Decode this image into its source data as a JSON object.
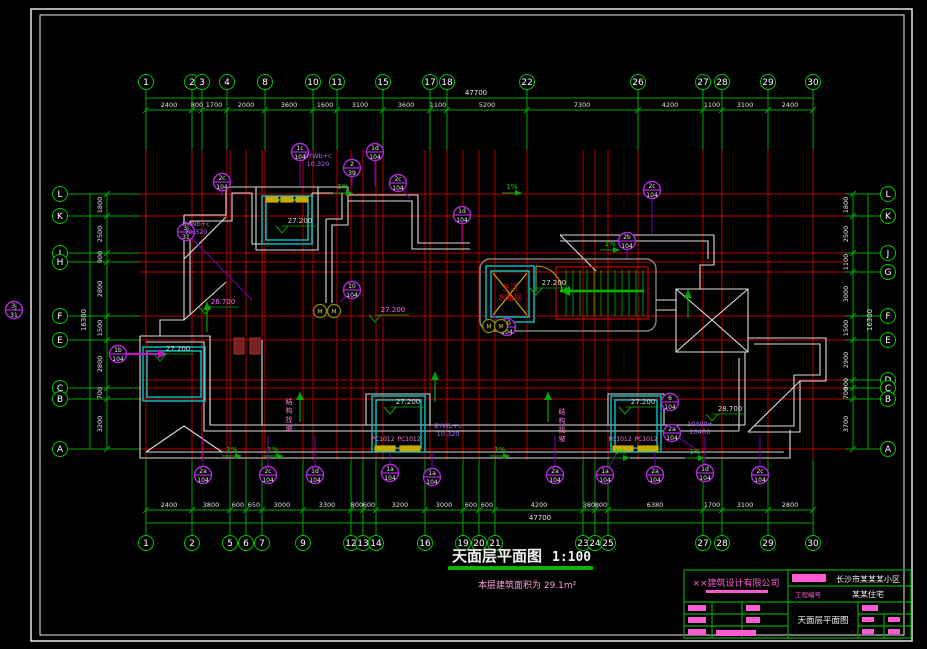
{
  "colors": {
    "background": "#000000",
    "frame": "#e8e8e8",
    "grid_line": "#b40000",
    "dim_line": "#00a800",
    "dim_text": "#e0e0e0",
    "bubble": "#00c800",
    "outline": "#dcdcdc",
    "shaft_cyan": "#00c8c8",
    "callout_purple": "#b428dc",
    "annotation_pink": "#ff78dc",
    "yellow": "#c8aa00",
    "red_text": "#d01818",
    "stair_green": "#00b400",
    "core_gray": "#9a9a9a",
    "olive": "#8a8a00"
  },
  "title": {
    "text": "天面层平面图",
    "scale": "1:100",
    "area_note": "本层建筑面积为 29.1m²"
  },
  "grid": {
    "vlines": [
      {
        "x": 146,
        "n": "1",
        "t": true,
        "b": true
      },
      {
        "x": 192,
        "n": "2",
        "t": true,
        "b": true
      },
      {
        "x": 202,
        "n": "3",
        "t": true,
        "b": false
      },
      {
        "x": 227,
        "n": "4",
        "t": true,
        "b": false
      },
      {
        "x": 230,
        "n": "5",
        "t": false,
        "b": true
      },
      {
        "x": 246,
        "n": "6",
        "t": false,
        "b": true
      },
      {
        "x": 262,
        "n": "7",
        "t": false,
        "b": true
      },
      {
        "x": 265,
        "n": "8",
        "t": true,
        "b": false
      },
      {
        "x": 303,
        "n": "9",
        "t": false,
        "b": true
      },
      {
        "x": 313,
        "n": "10",
        "t": true,
        "b": false
      },
      {
        "x": 337,
        "n": "11",
        "t": true,
        "b": false
      },
      {
        "x": 351,
        "n": "12",
        "t": false,
        "b": true
      },
      {
        "x": 363,
        "n": "13",
        "t": false,
        "b": true
      },
      {
        "x": 376,
        "n": "14",
        "t": false,
        "b": true
      },
      {
        "x": 383,
        "n": "15",
        "t": true,
        "b": false
      },
      {
        "x": 425,
        "n": "16",
        "t": false,
        "b": true
      },
      {
        "x": 430,
        "n": "17",
        "t": true,
        "b": false
      },
      {
        "x": 447,
        "n": "18",
        "t": true,
        "b": false
      },
      {
        "x": 463,
        "n": "19",
        "t": false,
        "b": true
      },
      {
        "x": 479,
        "n": "20",
        "t": false,
        "b": true
      },
      {
        "x": 495,
        "n": "21",
        "t": false,
        "b": true
      },
      {
        "x": 527,
        "n": "22",
        "t": true,
        "b": false
      },
      {
        "x": 583,
        "n": "23",
        "t": false,
        "b": true
      },
      {
        "x": 595,
        "n": "24",
        "t": false,
        "b": true
      },
      {
        "x": 608,
        "n": "25",
        "t": false,
        "b": true
      },
      {
        "x": 638,
        "n": "26",
        "t": true,
        "b": false
      },
      {
        "x": 703,
        "n": "27",
        "t": true,
        "b": true
      },
      {
        "x": 722,
        "n": "28",
        "t": true,
        "b": true
      },
      {
        "x": 768,
        "n": "29",
        "t": true,
        "b": true
      },
      {
        "x": 813,
        "n": "30",
        "t": true,
        "b": true
      }
    ],
    "hlines": [
      {
        "y": 194,
        "n": "L",
        "l": true,
        "r": true
      },
      {
        "y": 216,
        "n": "K",
        "l": true,
        "r": true
      },
      {
        "y": 253,
        "n": "J",
        "l": true,
        "r": true
      },
      {
        "y": 262,
        "n": "H",
        "l": true,
        "r": false
      },
      {
        "y": 272,
        "n": "G",
        "l": false,
        "r": true
      },
      {
        "y": 316,
        "n": "F",
        "l": true,
        "r": true
      },
      {
        "y": 340,
        "n": "E",
        "l": true,
        "r": true
      },
      {
        "y": 380,
        "n": "D",
        "l": false,
        "r": true
      },
      {
        "y": 388,
        "n": "C",
        "l": true,
        "r": true
      },
      {
        "y": 399,
        "n": "B",
        "l": true,
        "r": true
      },
      {
        "y": 449,
        "n": "A",
        "l": true,
        "r": true
      }
    ]
  },
  "dimensions": {
    "top": {
      "overall": "47700",
      "segments": [
        {
          "x": 169,
          "v": "2400"
        },
        {
          "x": 197,
          "v": "800"
        },
        {
          "x": 214,
          "v": "1700"
        },
        {
          "x": 246,
          "v": "2000"
        },
        {
          "x": 289,
          "v": "3600"
        },
        {
          "x": 325,
          "v": "1600"
        },
        {
          "x": 360,
          "v": "3100"
        },
        {
          "x": 406,
          "v": "3600"
        },
        {
          "x": 438,
          "v": "1100"
        },
        {
          "x": 487,
          "v": "5200"
        },
        {
          "x": 582,
          "v": "7300"
        },
        {
          "x": 670,
          "v": "4200"
        },
        {
          "x": 712,
          "v": "1100"
        },
        {
          "x": 745,
          "v": "3100"
        },
        {
          "x": 790,
          "v": "2400"
        }
      ]
    },
    "bottom": {
      "overall": "47700",
      "segments": [
        {
          "x": 169,
          "v": "2400"
        },
        {
          "x": 211,
          "v": "3800"
        },
        {
          "x": 238,
          "v": "600"
        },
        {
          "x": 254,
          "v": "650"
        },
        {
          "x": 282,
          "v": "3000"
        },
        {
          "x": 327,
          "v": "3300"
        },
        {
          "x": 357,
          "v": "800"
        },
        {
          "x": 369,
          "v": "600"
        },
        {
          "x": 400,
          "v": "3200"
        },
        {
          "x": 444,
          "v": "3000"
        },
        {
          "x": 471,
          "v": "600"
        },
        {
          "x": 487,
          "v": "600"
        },
        {
          "x": 539,
          "v": "4200"
        },
        {
          "x": 589,
          "v": "380"
        },
        {
          "x": 601,
          "v": "800"
        },
        {
          "x": 655,
          "v": "6380"
        },
        {
          "x": 712,
          "v": "1700"
        },
        {
          "x": 745,
          "v": "3100"
        },
        {
          "x": 790,
          "v": "2800"
        }
      ]
    },
    "left": {
      "overall": "16300",
      "segments": [
        {
          "y": 205,
          "v": "1800"
        },
        {
          "y": 234,
          "v": "2500"
        },
        {
          "y": 257,
          "v": "900"
        },
        {
          "y": 289,
          "v": "2800"
        },
        {
          "y": 328,
          "v": "1500"
        },
        {
          "y": 364,
          "v": "2800"
        },
        {
          "y": 393,
          "v": "700"
        },
        {
          "y": 424,
          "v": "3200"
        }
      ]
    },
    "right": {
      "overall": "16300",
      "segments": [
        {
          "y": 205,
          "v": "1800"
        },
        {
          "y": 234,
          "v": "2500"
        },
        {
          "y": 262,
          "v": "1100"
        },
        {
          "y": 294,
          "v": "3000"
        },
        {
          "y": 328,
          "v": "1500"
        },
        {
          "y": 360,
          "v": "2900"
        },
        {
          "y": 384,
          "v": "900"
        },
        {
          "y": 393,
          "v": "700"
        },
        {
          "y": 424,
          "v": "3700"
        }
      ]
    }
  },
  "elevations": [
    {
      "x": 282,
      "y": 222,
      "t": "27.200",
      "c": "#d8d8d8"
    },
    {
      "x": 160,
      "y": 350,
      "t": "27.200",
      "c": "#d8d8d8"
    },
    {
      "x": 390,
      "y": 403,
      "t": "27.200",
      "c": "#d8d8d8"
    },
    {
      "x": 625,
      "y": 403,
      "t": "27.200",
      "c": "#d8d8d8"
    },
    {
      "x": 536,
      "y": 284,
      "t": "27.200",
      "c": "#d8d8d8"
    },
    {
      "x": 205,
      "y": 303,
      "t": "26.700",
      "c": "#ff66ff"
    },
    {
      "x": 375,
      "y": 311,
      "t": "27.200",
      "c": "#ff66ff"
    },
    {
      "x": 712,
      "y": 410,
      "t": "28.700",
      "c": "#d8d8d8"
    }
  ],
  "callouts": [
    {
      "x": 222,
      "y": 182,
      "a": "2c",
      "b": "104",
      "lx": 222,
      "ly": 196
    },
    {
      "x": 300,
      "y": 152,
      "a": "1c",
      "b": "104",
      "lx": 300,
      "ly": 186
    },
    {
      "x": 375,
      "y": 152,
      "a": "1d",
      "b": "104",
      "lx": 375,
      "ly": 186
    },
    {
      "x": 398,
      "y": 183,
      "a": "2c",
      "b": "104",
      "lx": 410,
      "ly": 199
    },
    {
      "x": 462,
      "y": 215,
      "a": "1d",
      "b": "104",
      "lx": 462,
      "ly": 242
    },
    {
      "x": 652,
      "y": 190,
      "a": "2c",
      "b": "104",
      "lx": 652,
      "ly": 234
    },
    {
      "x": 627,
      "y": 241,
      "a": "2b",
      "b": "104",
      "lx": 627,
      "ly": 258
    },
    {
      "x": 507,
      "y": 327,
      "a": "10",
      "b": "104",
      "lx": 492,
      "ly": 315
    },
    {
      "x": 352,
      "y": 290,
      "a": "10",
      "b": "104",
      "lx": 340,
      "ly": 302
    },
    {
      "x": 118,
      "y": 354,
      "a": "1b",
      "b": "104"
    },
    {
      "x": 186,
      "y": 232,
      "a": "3j",
      "b": "31",
      "lx": 252,
      "ly": 300
    },
    {
      "x": 352,
      "y": 168,
      "a": "2",
      "b": "39",
      "lx": 352,
      "ly": 186
    },
    {
      "x": 14,
      "y": 310,
      "a": "3j",
      "b": "31"
    },
    {
      "x": 203,
      "y": 475,
      "a": "2a",
      "b": "104",
      "lx": 203,
      "ly": 436
    },
    {
      "x": 268,
      "y": 475,
      "a": "2c",
      "b": "104",
      "lx": 268,
      "ly": 436
    },
    {
      "x": 315,
      "y": 475,
      "a": "1d",
      "b": "104",
      "lx": 315,
      "ly": 436
    },
    {
      "x": 390,
      "y": 473,
      "a": "1a",
      "b": "104",
      "lx": 390,
      "ly": 452
    },
    {
      "x": 432,
      "y": 477,
      "a": "1a",
      "b": "104",
      "lx": 432,
      "ly": 452
    },
    {
      "x": 555,
      "y": 475,
      "a": "2a",
      "b": "104",
      "lx": 555,
      "ly": 436
    },
    {
      "x": 605,
      "y": 475,
      "a": "1a",
      "b": "104",
      "lx": 617,
      "ly": 452
    },
    {
      "x": 655,
      "y": 475,
      "a": "2a",
      "b": "104",
      "lx": 655,
      "ly": 452
    },
    {
      "x": 705,
      "y": 473,
      "a": "1d",
      "b": "104",
      "lx": 705,
      "ly": 436
    },
    {
      "x": 760,
      "y": 475,
      "a": "2c",
      "b": "104",
      "lx": 760,
      "ly": 436
    },
    {
      "x": 670,
      "y": 402,
      "a": "6",
      "b": "104",
      "lx": 660,
      "ly": 412
    },
    {
      "x": 672,
      "y": 433,
      "a": "2a",
      "b": "104",
      "lx": 700,
      "ly": 452
    }
  ],
  "purple_notes": [
    {
      "x": 318,
      "y": 158,
      "lines": [
        "BYWb+c",
        "10.320"
      ]
    },
    {
      "x": 196,
      "y": 226,
      "lines": [
        "BYWb+c",
        "10.320"
      ]
    },
    {
      "x": 448,
      "y": 428,
      "lines": [
        "BYWb+c",
        "10.320"
      ]
    },
    {
      "x": 700,
      "y": 426,
      "lines": [
        "10400+",
        "10400"
      ]
    }
  ],
  "vertical_notes": [
    {
      "x": 289,
      "y": 404,
      "t": "结构找坡"
    },
    {
      "x": 562,
      "y": 414,
      "t": "结构找坡"
    }
  ],
  "slope_labels": [
    {
      "x": 232,
      "y": 453
    },
    {
      "x": 273,
      "y": 453
    },
    {
      "x": 343,
      "y": 190
    },
    {
      "x": 512,
      "y": 190
    },
    {
      "x": 500,
      "y": 453
    },
    {
      "x": 620,
      "y": 455
    },
    {
      "x": 695,
      "y": 455
    },
    {
      "x": 610,
      "y": 247
    }
  ],
  "slope_text": "1%",
  "window_tags": [
    {
      "x": 383,
      "y": 441,
      "t": "PC1012"
    },
    {
      "x": 409,
      "y": 441,
      "t": "PC1012"
    },
    {
      "x": 620,
      "y": 441,
      "t": "PC1012"
    },
    {
      "x": 646,
      "y": 441,
      "t": "PC1012"
    }
  ],
  "olive_markers": [
    {
      "x": 320,
      "y": 311,
      "t": "M"
    },
    {
      "x": 334,
      "y": 311,
      "t": "M"
    },
    {
      "x": 489,
      "y": 326,
      "t": "M"
    },
    {
      "x": 501,
      "y": 326,
      "t": "M"
    }
  ],
  "core": {
    "label_line1": "生活",
    "label_line2": "水箱间"
  },
  "titleblock": {
    "company": "××建筑设计有限公司",
    "project": "长沙市某某某小区",
    "project_no_label": "工程编号",
    "building": "某某住宅",
    "drawing_name": "天面层平面图"
  }
}
